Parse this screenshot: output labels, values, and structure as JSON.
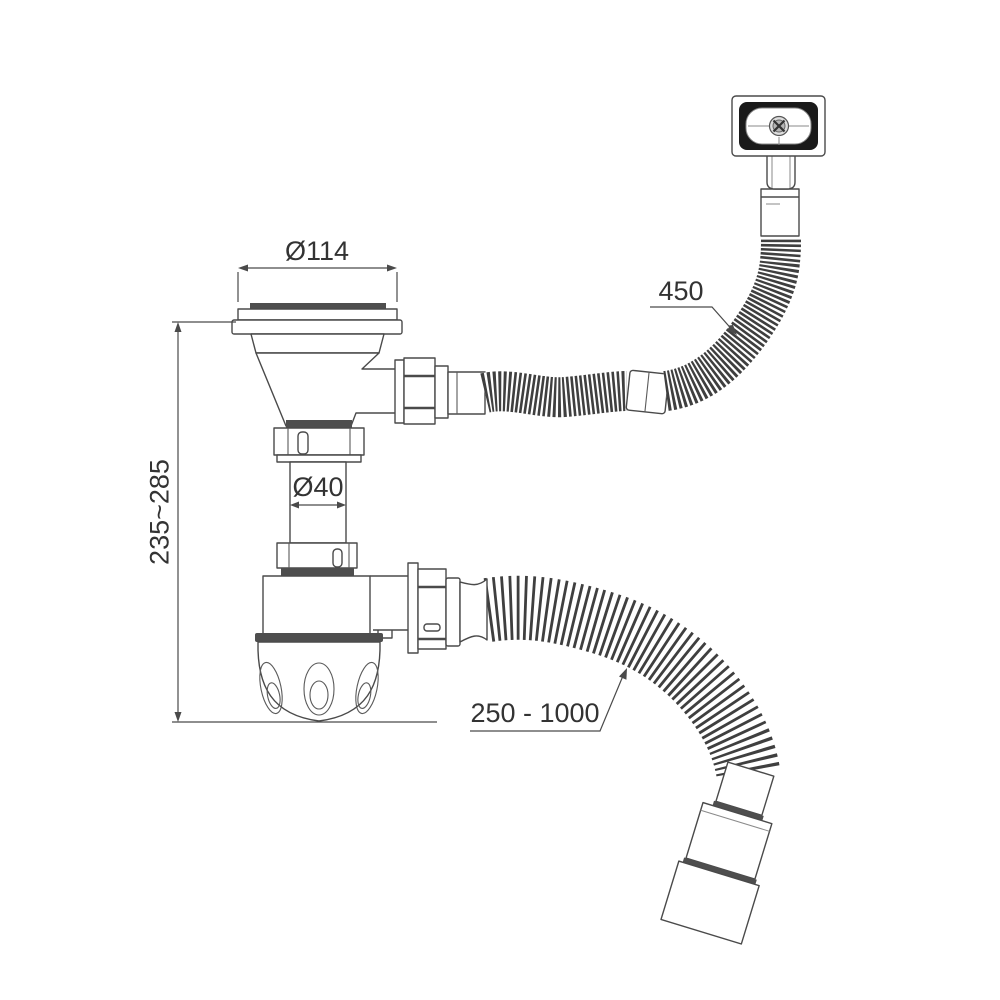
{
  "labels": {
    "strainer_diameter": "Ø114",
    "tailpipe_diameter": "Ø40",
    "body_height_range": "235~285",
    "overflow_hose_length": "450",
    "outlet_hose_length": "250 - 1000"
  },
  "colors": {
    "background": "#ffffff",
    "line": "#4a4a4a",
    "dark_fill": "#4e4e4e",
    "hose_rib": "#3f3f3f",
    "cover_frame": "#1a1a1a",
    "text": "#333333"
  }
}
